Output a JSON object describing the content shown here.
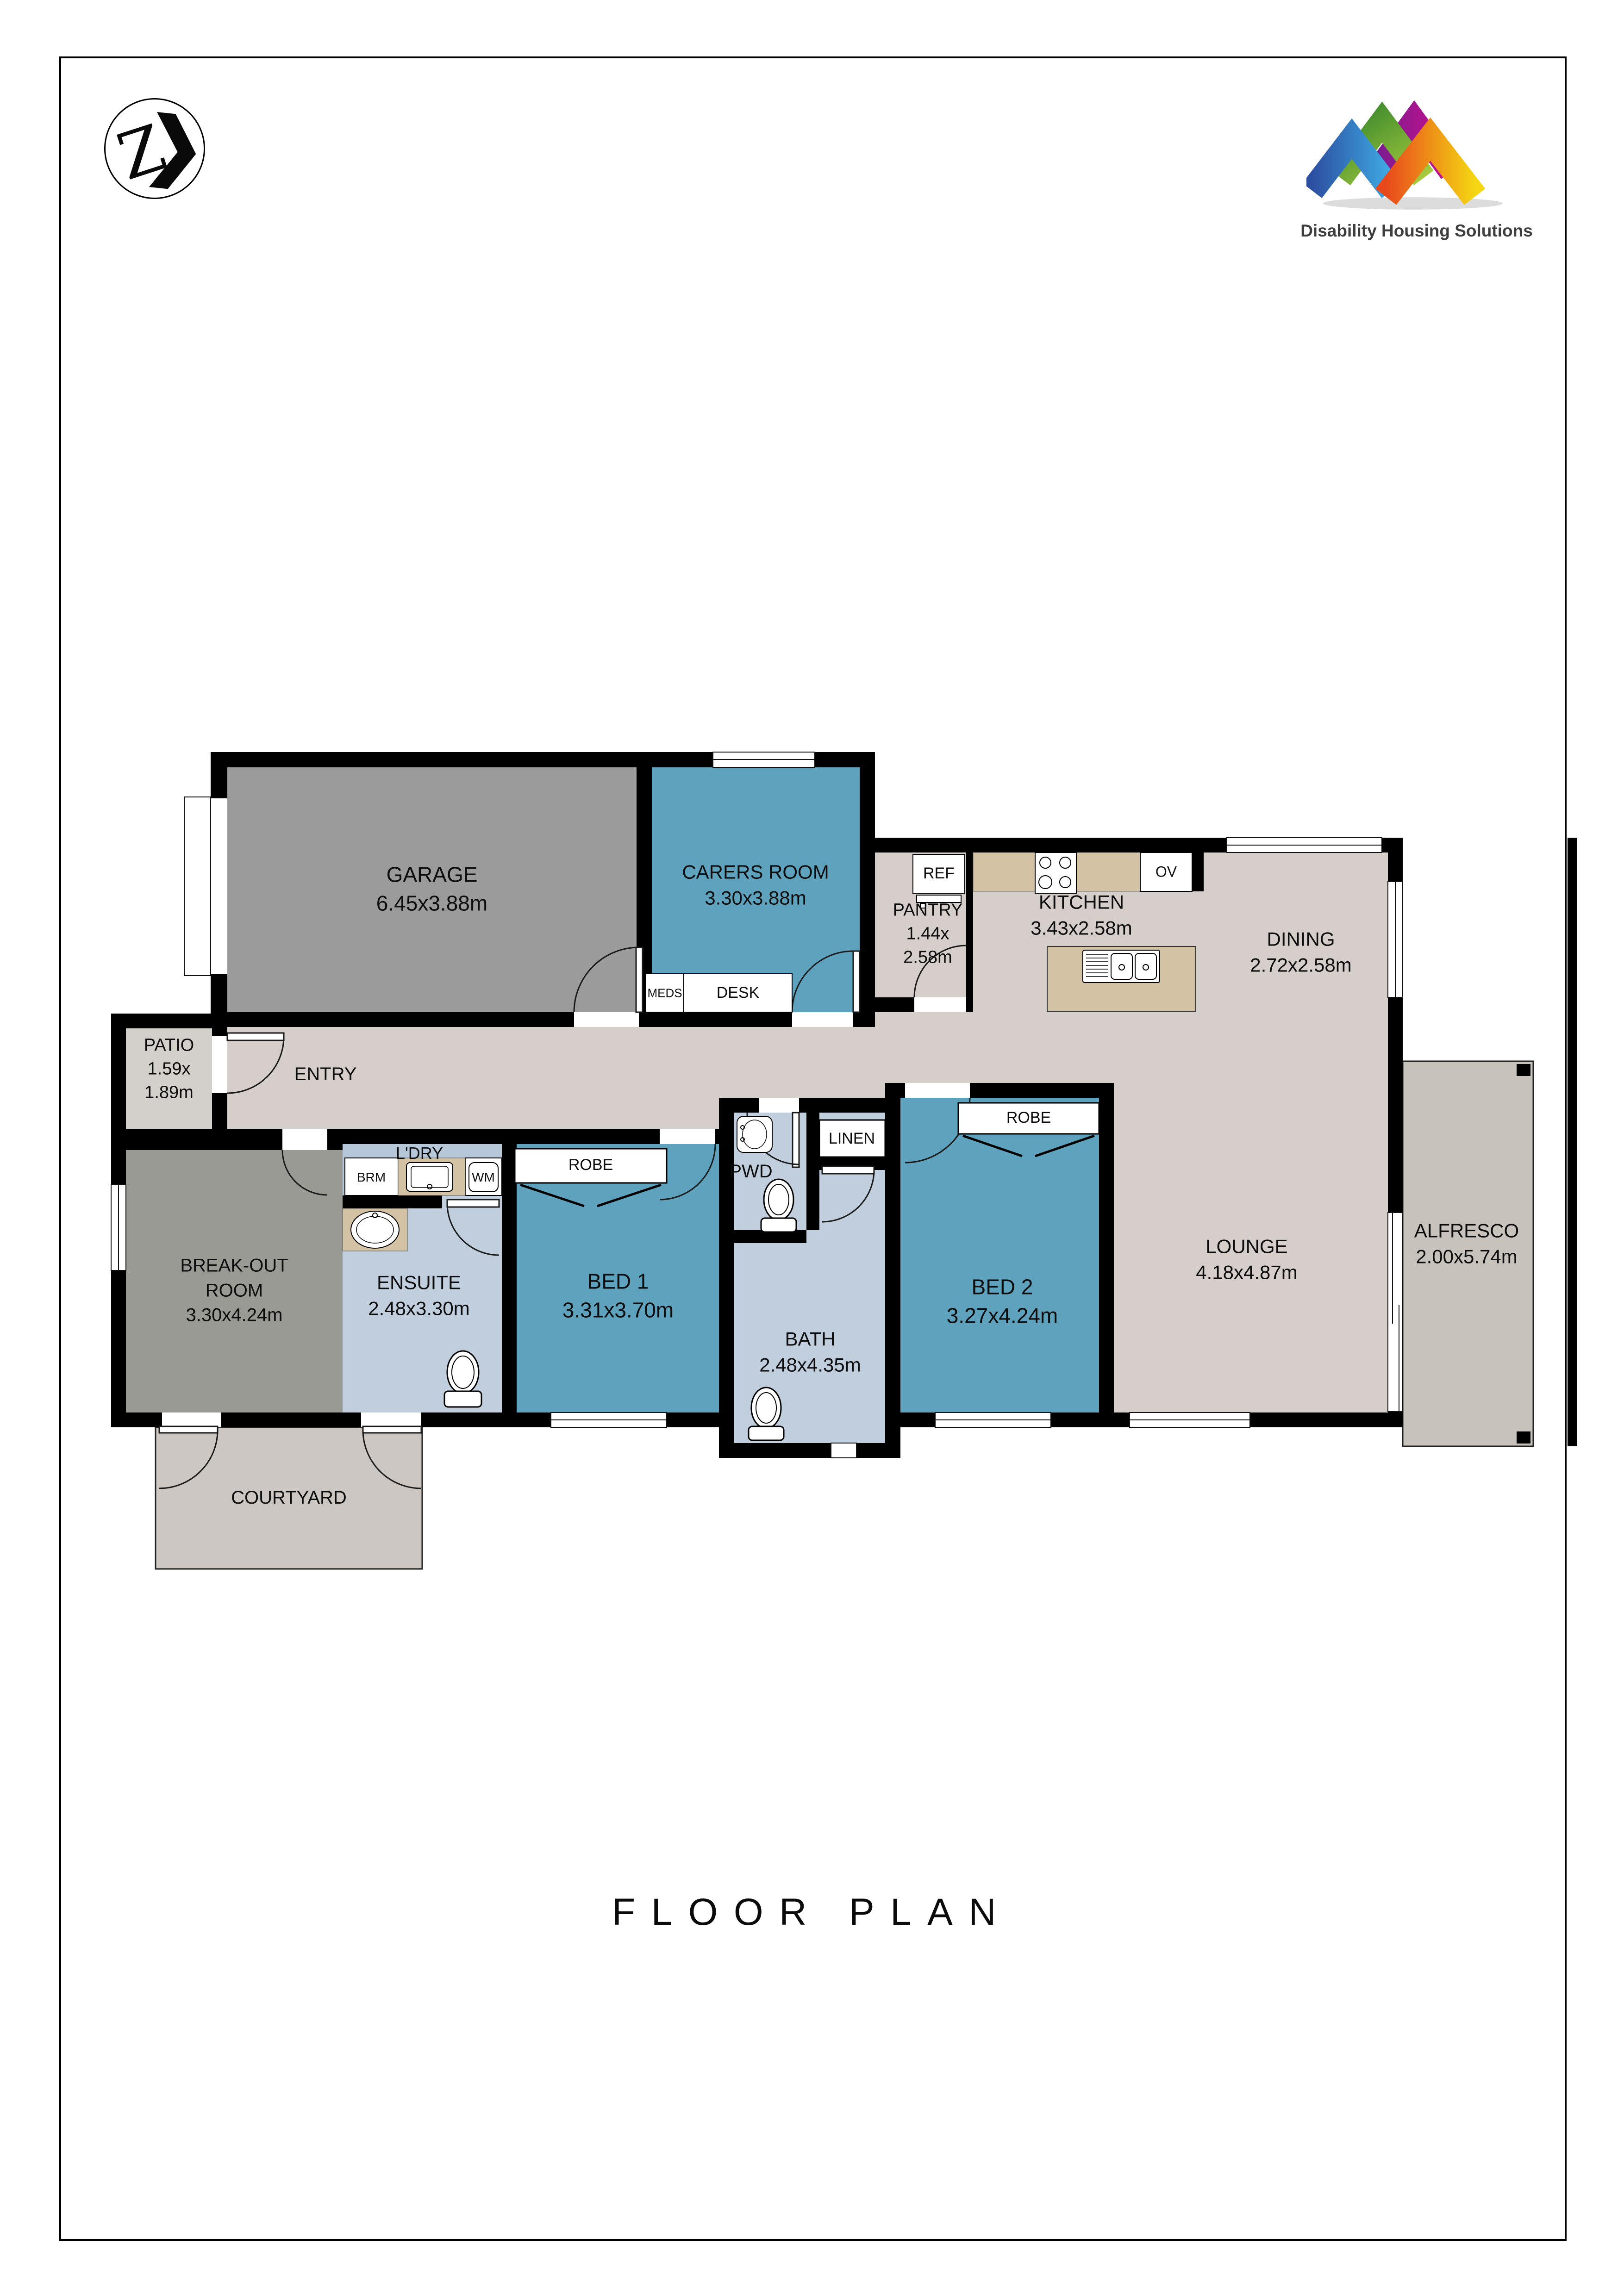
{
  "header": {
    "monogram": {
      "letter": "Z",
      "chevron": "❯"
    },
    "brand": {
      "name": "Disability Housing Solutions",
      "text_color": "#3e3e3e"
    }
  },
  "title": "FLOOR PLAN",
  "rooms": {
    "garage": {
      "name": "GARAGE",
      "dims": "6.45x3.88m"
    },
    "carers": {
      "name": "CARERS ROOM",
      "dims": "3.30x3.88m"
    },
    "pantry": {
      "name": "PANTRY",
      "dims": "1.44x\n2.58m"
    },
    "kitchen": {
      "name": "KITCHEN",
      "dims": "3.43x2.58m"
    },
    "dining": {
      "name": "DINING",
      "dims": "2.72x2.58m"
    },
    "patio": {
      "name": "PATIO",
      "dims": "1.59x\n1.89m"
    },
    "entry": {
      "name": "ENTRY"
    },
    "breakout": {
      "name": "BREAK-OUT\nROOM",
      "dims": "3.30x4.24m"
    },
    "ensuite": {
      "name": "ENSUITE",
      "dims": "2.48x3.30m"
    },
    "laundry": {
      "name": "L'DRY"
    },
    "bed1": {
      "name": "BED 1",
      "dims": "3.31x3.70m"
    },
    "pwd": {
      "name": "PWD"
    },
    "linen": {
      "name": "LINEN"
    },
    "bath": {
      "name": "BATH",
      "dims": "2.48x4.35m"
    },
    "bed2": {
      "name": "BED 2",
      "dims": "3.27x4.24m"
    },
    "lounge": {
      "name": "LOUNGE",
      "dims": "4.18x4.87m"
    },
    "alfresco": {
      "name": "ALFRESCO",
      "dims": "2.00x5.74m"
    },
    "courtyard": {
      "name": "COURTYARD"
    }
  },
  "fixtures": {
    "fridge": "REF",
    "oven": "OV",
    "meds": "MEDS",
    "desk": "DESK",
    "broom": "BRM",
    "washer": "WM",
    "robe_bed1": "ROBE",
    "robe_bed2": "ROBE"
  },
  "colors": {
    "wall": "#000000",
    "floor": "#d5cecb",
    "bedroom_teal": "#5fa2bd",
    "bathroom_blue": "#c0cedd",
    "laundry_blue": "#b6c7d9",
    "garage_gray": "#9b9b9b",
    "breakout_gray": "#9a9a94",
    "patio_gray": "#d3cfcb",
    "courtyard_gray": "#ccc7c3",
    "alfresco_gray": "#c7c2bb",
    "bench_beige": "#d3c3a4",
    "brand_blue": [
      "#2d4fa2",
      "#3fabe4"
    ],
    "brand_green": [
      "#3e8a2e",
      "#a6cb3c"
    ],
    "brand_magenta": [
      "#7b1d8f",
      "#cb0f8e"
    ],
    "brand_orange": [
      "#e8491c",
      "#f4d612"
    ]
  }
}
